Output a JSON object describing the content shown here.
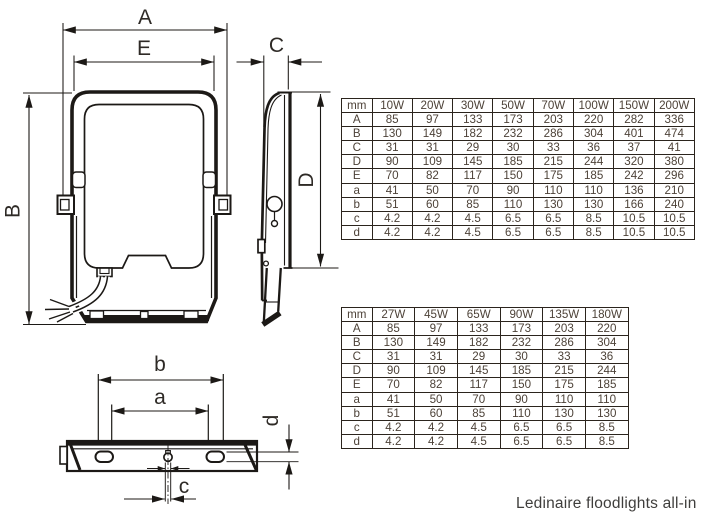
{
  "caption": "Ledinaire floodlights all-in",
  "drawing": {
    "front": {
      "width_label": "A",
      "opening_label": "E",
      "height_label": "B"
    },
    "side": {
      "depth_label": "C",
      "height_label": "D"
    },
    "bottom": {
      "outer_span_label": "b",
      "inner_span_label": "a",
      "slot_width_label": "c",
      "slot_height_label": "d"
    }
  },
  "tables": [
    {
      "unit": "mm",
      "columns": [
        "10W",
        "20W",
        "30W",
        "50W",
        "70W",
        "100W",
        "150W",
        "200W"
      ],
      "rows": [
        {
          "label": "A",
          "values": [
            "85",
            "97",
            "133",
            "173",
            "203",
            "220",
            "282",
            "336"
          ]
        },
        {
          "label": "B",
          "values": [
            "130",
            "149",
            "182",
            "232",
            "286",
            "304",
            "401",
            "474"
          ]
        },
        {
          "label": "C",
          "values": [
            "31",
            "31",
            "29",
            "30",
            "33",
            "36",
            "37",
            "41"
          ]
        },
        {
          "label": "D",
          "values": [
            "90",
            "109",
            "145",
            "185",
            "215",
            "244",
            "320",
            "380"
          ]
        },
        {
          "label": "E",
          "values": [
            "70",
            "82",
            "117",
            "150",
            "175",
            "185",
            "242",
            "296"
          ]
        },
        {
          "label": "a",
          "values": [
            "41",
            "50",
            "70",
            "90",
            "110",
            "110",
            "136",
            "210"
          ]
        },
        {
          "label": "b",
          "values": [
            "51",
            "60",
            "85",
            "110",
            "130",
            "130",
            "166",
            "240"
          ]
        },
        {
          "label": "c",
          "values": [
            "4.2",
            "4.2",
            "4.5",
            "6.5",
            "6.5",
            "8.5",
            "10.5",
            "10.5"
          ]
        },
        {
          "label": "d",
          "values": [
            "4.2",
            "4.2",
            "4.5",
            "6.5",
            "6.5",
            "8.5",
            "10.5",
            "10.5"
          ]
        }
      ]
    },
    {
      "unit": "mm",
      "columns": [
        "27W",
        "45W",
        "65W",
        "90W",
        "135W",
        "180W"
      ],
      "rows": [
        {
          "label": "A",
          "values": [
            "85",
            "97",
            "133",
            "173",
            "203",
            "220"
          ]
        },
        {
          "label": "B",
          "values": [
            "130",
            "149",
            "182",
            "232",
            "286",
            "304"
          ]
        },
        {
          "label": "C",
          "values": [
            "31",
            "31",
            "29",
            "30",
            "33",
            "36"
          ]
        },
        {
          "label": "D",
          "values": [
            "90",
            "109",
            "145",
            "185",
            "215",
            "244"
          ]
        },
        {
          "label": "E",
          "values": [
            "70",
            "82",
            "117",
            "150",
            "175",
            "185"
          ]
        },
        {
          "label": "a",
          "values": [
            "41",
            "50",
            "70",
            "90",
            "110",
            "110"
          ]
        },
        {
          "label": "b",
          "values": [
            "51",
            "60",
            "85",
            "110",
            "130",
            "130"
          ]
        },
        {
          "label": "c",
          "values": [
            "4.2",
            "4.2",
            "4.5",
            "6.5",
            "6.5",
            "8.5"
          ]
        },
        {
          "label": "d",
          "values": [
            "4.2",
            "4.2",
            "4.5",
            "6.5",
            "6.5",
            "8.5"
          ]
        }
      ]
    }
  ],
  "colors": {
    "line": "#1c1916",
    "label_text": "#2e2a26",
    "table_text": "#4d4238",
    "table_border": "#2b241d"
  }
}
